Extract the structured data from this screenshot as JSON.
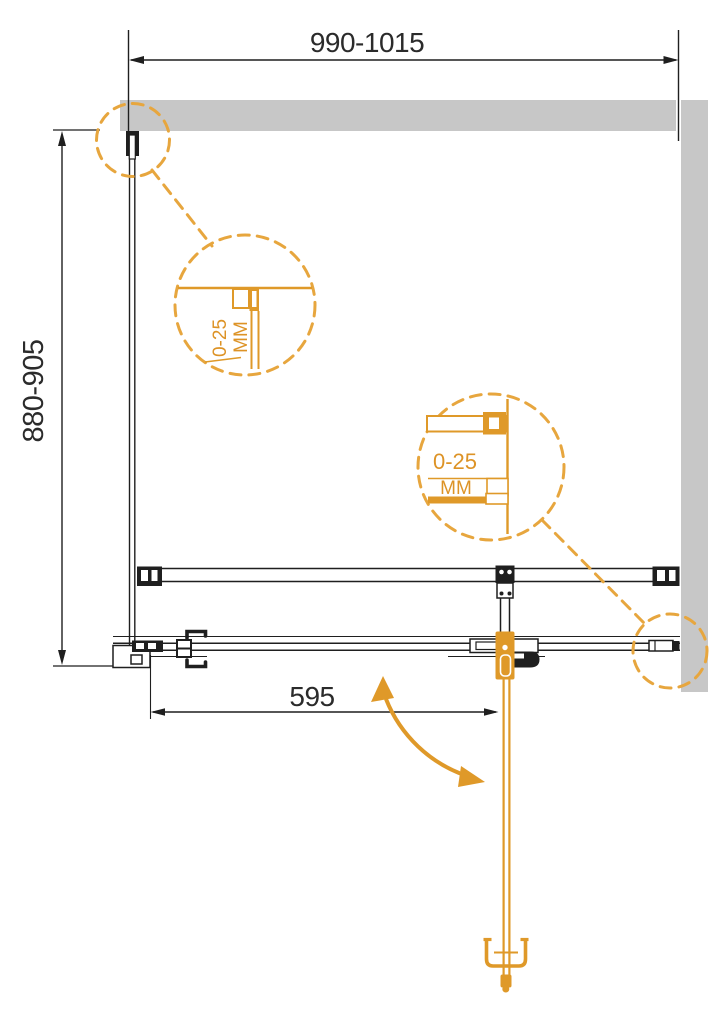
{
  "drawing": {
    "dims": {
      "overall_width": "990-1015",
      "overall_height": "880-905",
      "door_width": "595"
    },
    "detail_top": {
      "range": "0-25",
      "unit": "MM"
    },
    "detail_right": {
      "range": "0-25",
      "unit": "MM"
    },
    "colors": {
      "accent": "#DF9929",
      "dash": "#E7A63E",
      "wall": "#C7C7C7",
      "line": "#1F1F1F"
    }
  }
}
